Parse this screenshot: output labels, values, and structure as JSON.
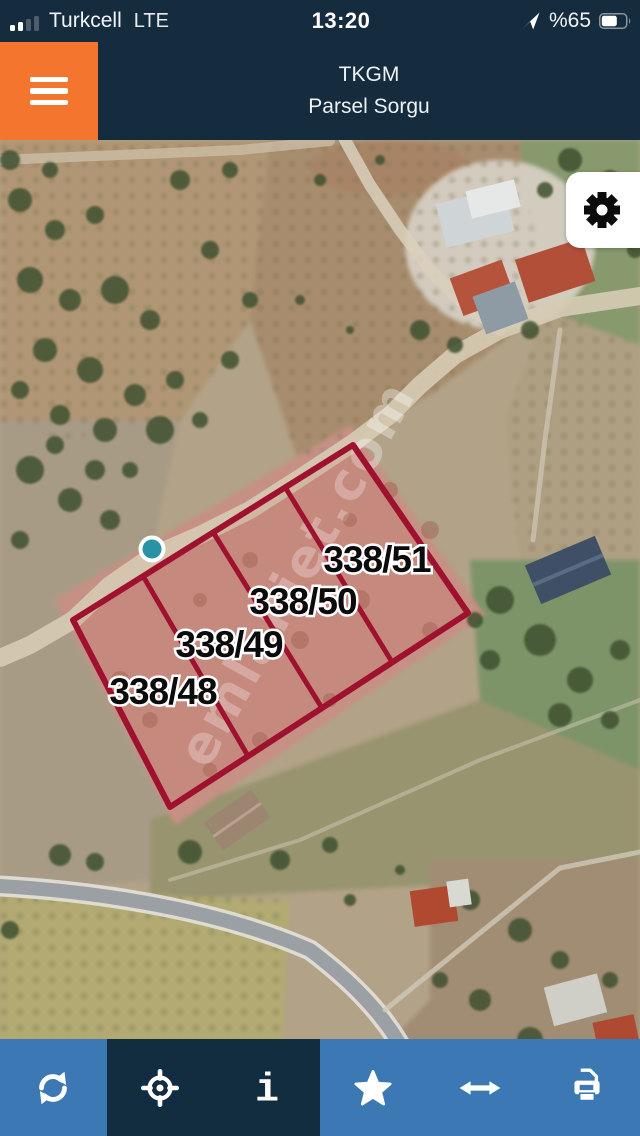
{
  "status_bar": {
    "carrier": "Turkcell",
    "network": "LTE",
    "time": "13:20",
    "battery_percent": "%65",
    "icons": {
      "signal": "signal-bars-icon",
      "location": "location-arrow-icon",
      "battery": "battery-icon"
    }
  },
  "header": {
    "title_line1": "TKGM",
    "title_line2": "Parsel Sorgu",
    "menu_icon": "hamburger-menu-icon",
    "bar_color": "#152b3e",
    "menu_button_color": "#f4762e"
  },
  "map": {
    "view_type": "satellite",
    "watermark": "emlakjet.com",
    "marker": {
      "name": "location-dot",
      "color": "#2a92a5"
    },
    "parcel_outline_color": "#9e1230",
    "parcels": [
      {
        "label": "338/48"
      },
      {
        "label": "338/49"
      },
      {
        "label": "338/50"
      },
      {
        "label": "338/51"
      }
    ],
    "settings_icon": "gear-icon"
  },
  "toolbar": {
    "background": "#3c78b4",
    "active_background": "#122c40",
    "buttons": [
      {
        "icon": "refresh-icon"
      },
      {
        "icon": "locate-icon",
        "active": true
      },
      {
        "icon": "info-icon",
        "active": true
      },
      {
        "icon": "star-icon"
      },
      {
        "icon": "resize-horizontal-icon"
      },
      {
        "icon": "print-icon"
      }
    ]
  }
}
